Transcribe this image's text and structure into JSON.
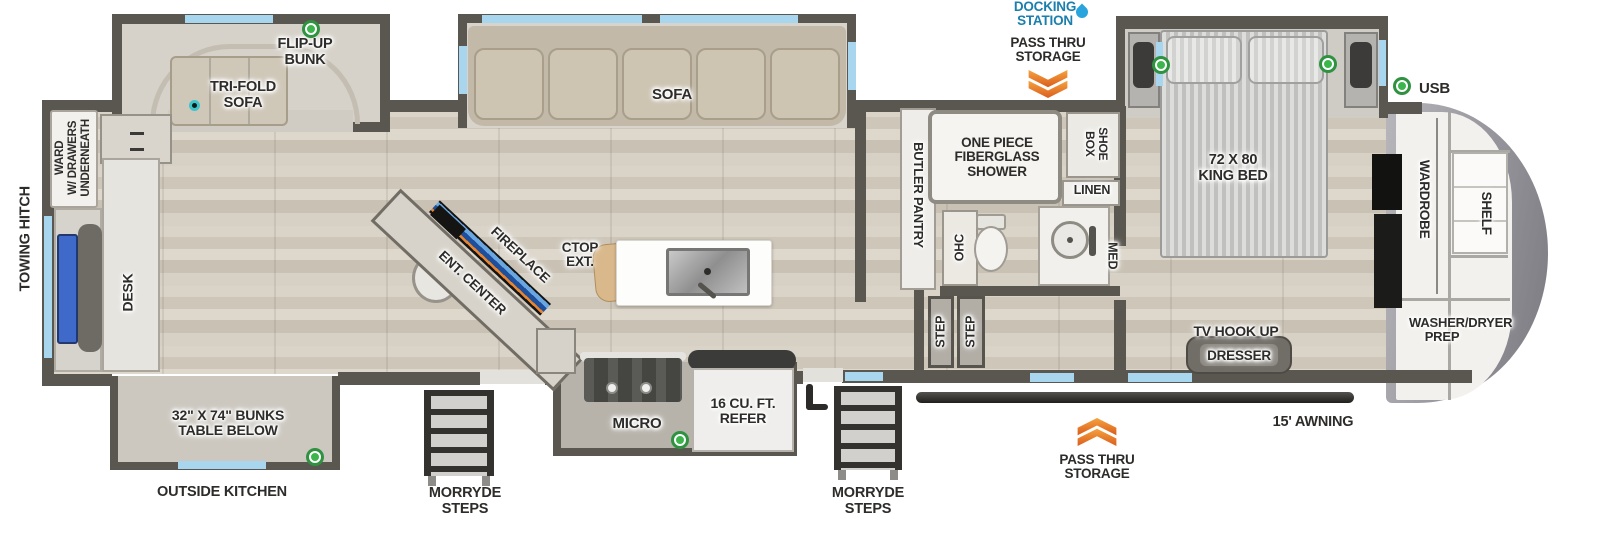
{
  "colors": {
    "wall": "#5a5650",
    "floor_wood": "#d5cfc4",
    "window_blue": "#a7d6ee",
    "desk_chair_blue": "#3f6ac9",
    "label_text": "#2d2c2a",
    "docking_text": "#1b7fae",
    "chevron_orange": "#e87426",
    "green_dot": "#3cb54c",
    "teal_dot": "#3fc4cc"
  },
  "exterior": {
    "towing_hitch": "TOWING HITCH",
    "outside_kitchen": "OUTSIDE KITCHEN",
    "morryde_steps": "MORRYDE STEPS",
    "awning": "15' AWNING",
    "docking_station": "DOCKING STATION",
    "pass_thru_storage": "PASS THRU STORAGE",
    "usb": "USB"
  },
  "rear_room": {
    "ward_lines": [
      "WARD",
      "W/ DRAWERS",
      "UNDERNEATH"
    ],
    "desk": "DESK",
    "tri_fold_sofa": "TRI-FOLD SOFA",
    "flip_up_bunk": "FLIP-UP BUNK",
    "bunks": "32\" X 74\" BUNKS TABLE BELOW"
  },
  "living_kitchen": {
    "sofa": "SOFA",
    "ent_center": "ENT. CENTER",
    "fireplace": "FIREPLACE",
    "ctop_ext": "CTOP EXT.",
    "micro": "MICRO",
    "refer": "16 CU. FT. REFER",
    "butler_pantry": "BUTLER PANTRY",
    "step": "STEP"
  },
  "bathroom": {
    "shower": "ONE PIECE FIBERGLASS SHOWER",
    "shoe_box": "SHOE BOX",
    "linen": "LINEN",
    "ohc": "OHC",
    "med": "MED"
  },
  "bedroom": {
    "king_bed": "72 X 80 KING BED",
    "tv_hook_up": "TV HOOK UP",
    "dresser": "DRESSER",
    "wardrobe": "WARDROBE",
    "shelf": "SHELF",
    "washer_dryer": "WASHER/DRYER PREP"
  }
}
